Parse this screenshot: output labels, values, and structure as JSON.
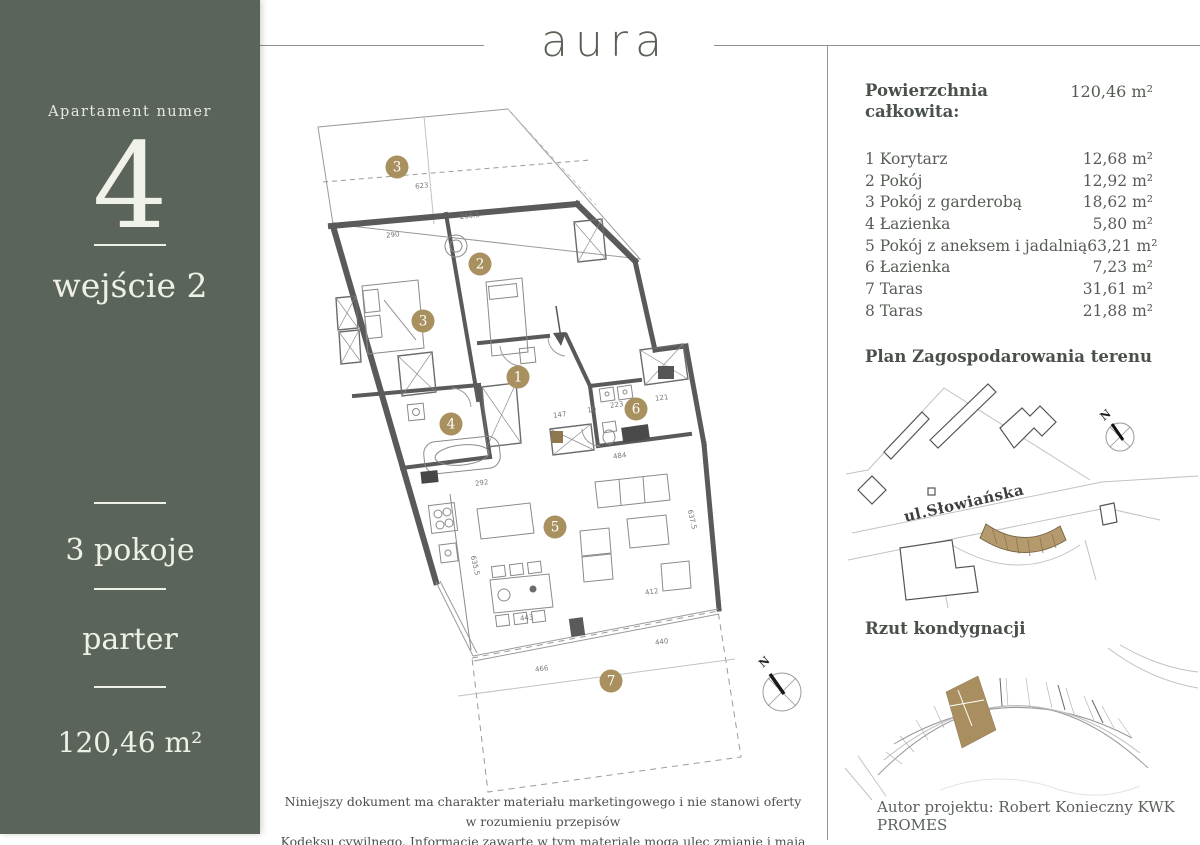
{
  "colors": {
    "sidebar_bg": "#5b645a",
    "accent_gold": "#a8905f",
    "highlight_tan": "#b59a6e",
    "wall_gray": "#5a5a5a"
  },
  "header": {
    "logo": "aura"
  },
  "sidebar": {
    "label": "Apartament numer",
    "apartment_number": "4",
    "entrance": "wejście 2",
    "rooms_count": "3 pokoje",
    "floor": "parter",
    "total_area": "120,46 m²"
  },
  "area_summary": {
    "title_line1": "Powierzchnia",
    "title_line2": "całkowita:",
    "total_value": "120,46 m²",
    "rooms": [
      {
        "no": "1",
        "name": "Korytarz",
        "area": "12,68 m²"
      },
      {
        "no": "2",
        "name": "Pokój",
        "area": "12,92 m²"
      },
      {
        "no": "3",
        "name": "Pokój z garderobą",
        "area": "18,62 m²"
      },
      {
        "no": "4",
        "name": "Łazienka",
        "area": "5,80 m²"
      },
      {
        "no": "5",
        "name": "Pokój z aneksem i jadalnią",
        "area": "63,21 m²"
      },
      {
        "no": "6",
        "name": "Łazienka",
        "area": "7,23 m²"
      },
      {
        "no": "7",
        "name": "Taras",
        "area": "31,61 m²"
      },
      {
        "no": "8",
        "name": "Taras",
        "area": "21,88 m²"
      }
    ]
  },
  "site_plan": {
    "title": "Plan Zagospodarowania terenu",
    "street_label": "ul.Słowiańska",
    "compass_label": "N"
  },
  "floor_locator": {
    "title": "Rzut kondygnacji",
    "author": "Autor projektu: Robert Konieczny KWK PROMES"
  },
  "floorplan": {
    "compass_label": "N",
    "markers": [
      {
        "no": "3",
        "x": 397,
        "y": 167
      },
      {
        "no": "2",
        "x": 480,
        "y": 264
      },
      {
        "no": "3",
        "x": 423,
        "y": 321
      },
      {
        "no": "1",
        "x": 518,
        "y": 377
      },
      {
        "no": "4",
        "x": 451,
        "y": 424
      },
      {
        "no": "6",
        "x": 636,
        "y": 409
      },
      {
        "no": "5",
        "x": 555,
        "y": 527
      },
      {
        "no": "7",
        "x": 611,
        "y": 681
      }
    ],
    "dimensions": [
      {
        "t": "623",
        "x": 422,
        "y": 188,
        "r": -6
      },
      {
        "t": "269.5",
        "x": 470,
        "y": 218,
        "r": -6
      },
      {
        "t": "290",
        "x": 393,
        "y": 237,
        "r": -6
      },
      {
        "t": "147",
        "x": 560,
        "y": 417,
        "r": -8
      },
      {
        "t": "10",
        "x": 592,
        "y": 412,
        "r": -8
      },
      {
        "t": "223",
        "x": 617,
        "y": 407,
        "r": -8
      },
      {
        "t": "121",
        "x": 662,
        "y": 400,
        "r": -8
      },
      {
        "t": "484",
        "x": 620,
        "y": 458,
        "r": -8
      },
      {
        "t": "292",
        "x": 482,
        "y": 485,
        "r": -8
      },
      {
        "t": "443",
        "x": 527,
        "y": 620,
        "r": -8
      },
      {
        "t": "466",
        "x": 542,
        "y": 671,
        "r": -8
      },
      {
        "t": "412",
        "x": 652,
        "y": 594,
        "r": -8
      },
      {
        "t": "440",
        "x": 662,
        "y": 644,
        "r": -8
      },
      {
        "t": "635.5",
        "x": 473,
        "y": 566,
        "r": 77
      },
      {
        "t": "637.5",
        "x": 690,
        "y": 520,
        "r": 77
      }
    ]
  },
  "footer": {
    "disclaimer_line1": "Niniejszy dokument ma charakter materiału marketingowego i nie stanowi oferty w rozumieniu przepisów",
    "disclaimer_line2": "Kodeksu cywilnego. Informacje zawarte w tym materiale mogą ulec zmianie i mają jedynie charakter informacyjny."
  }
}
